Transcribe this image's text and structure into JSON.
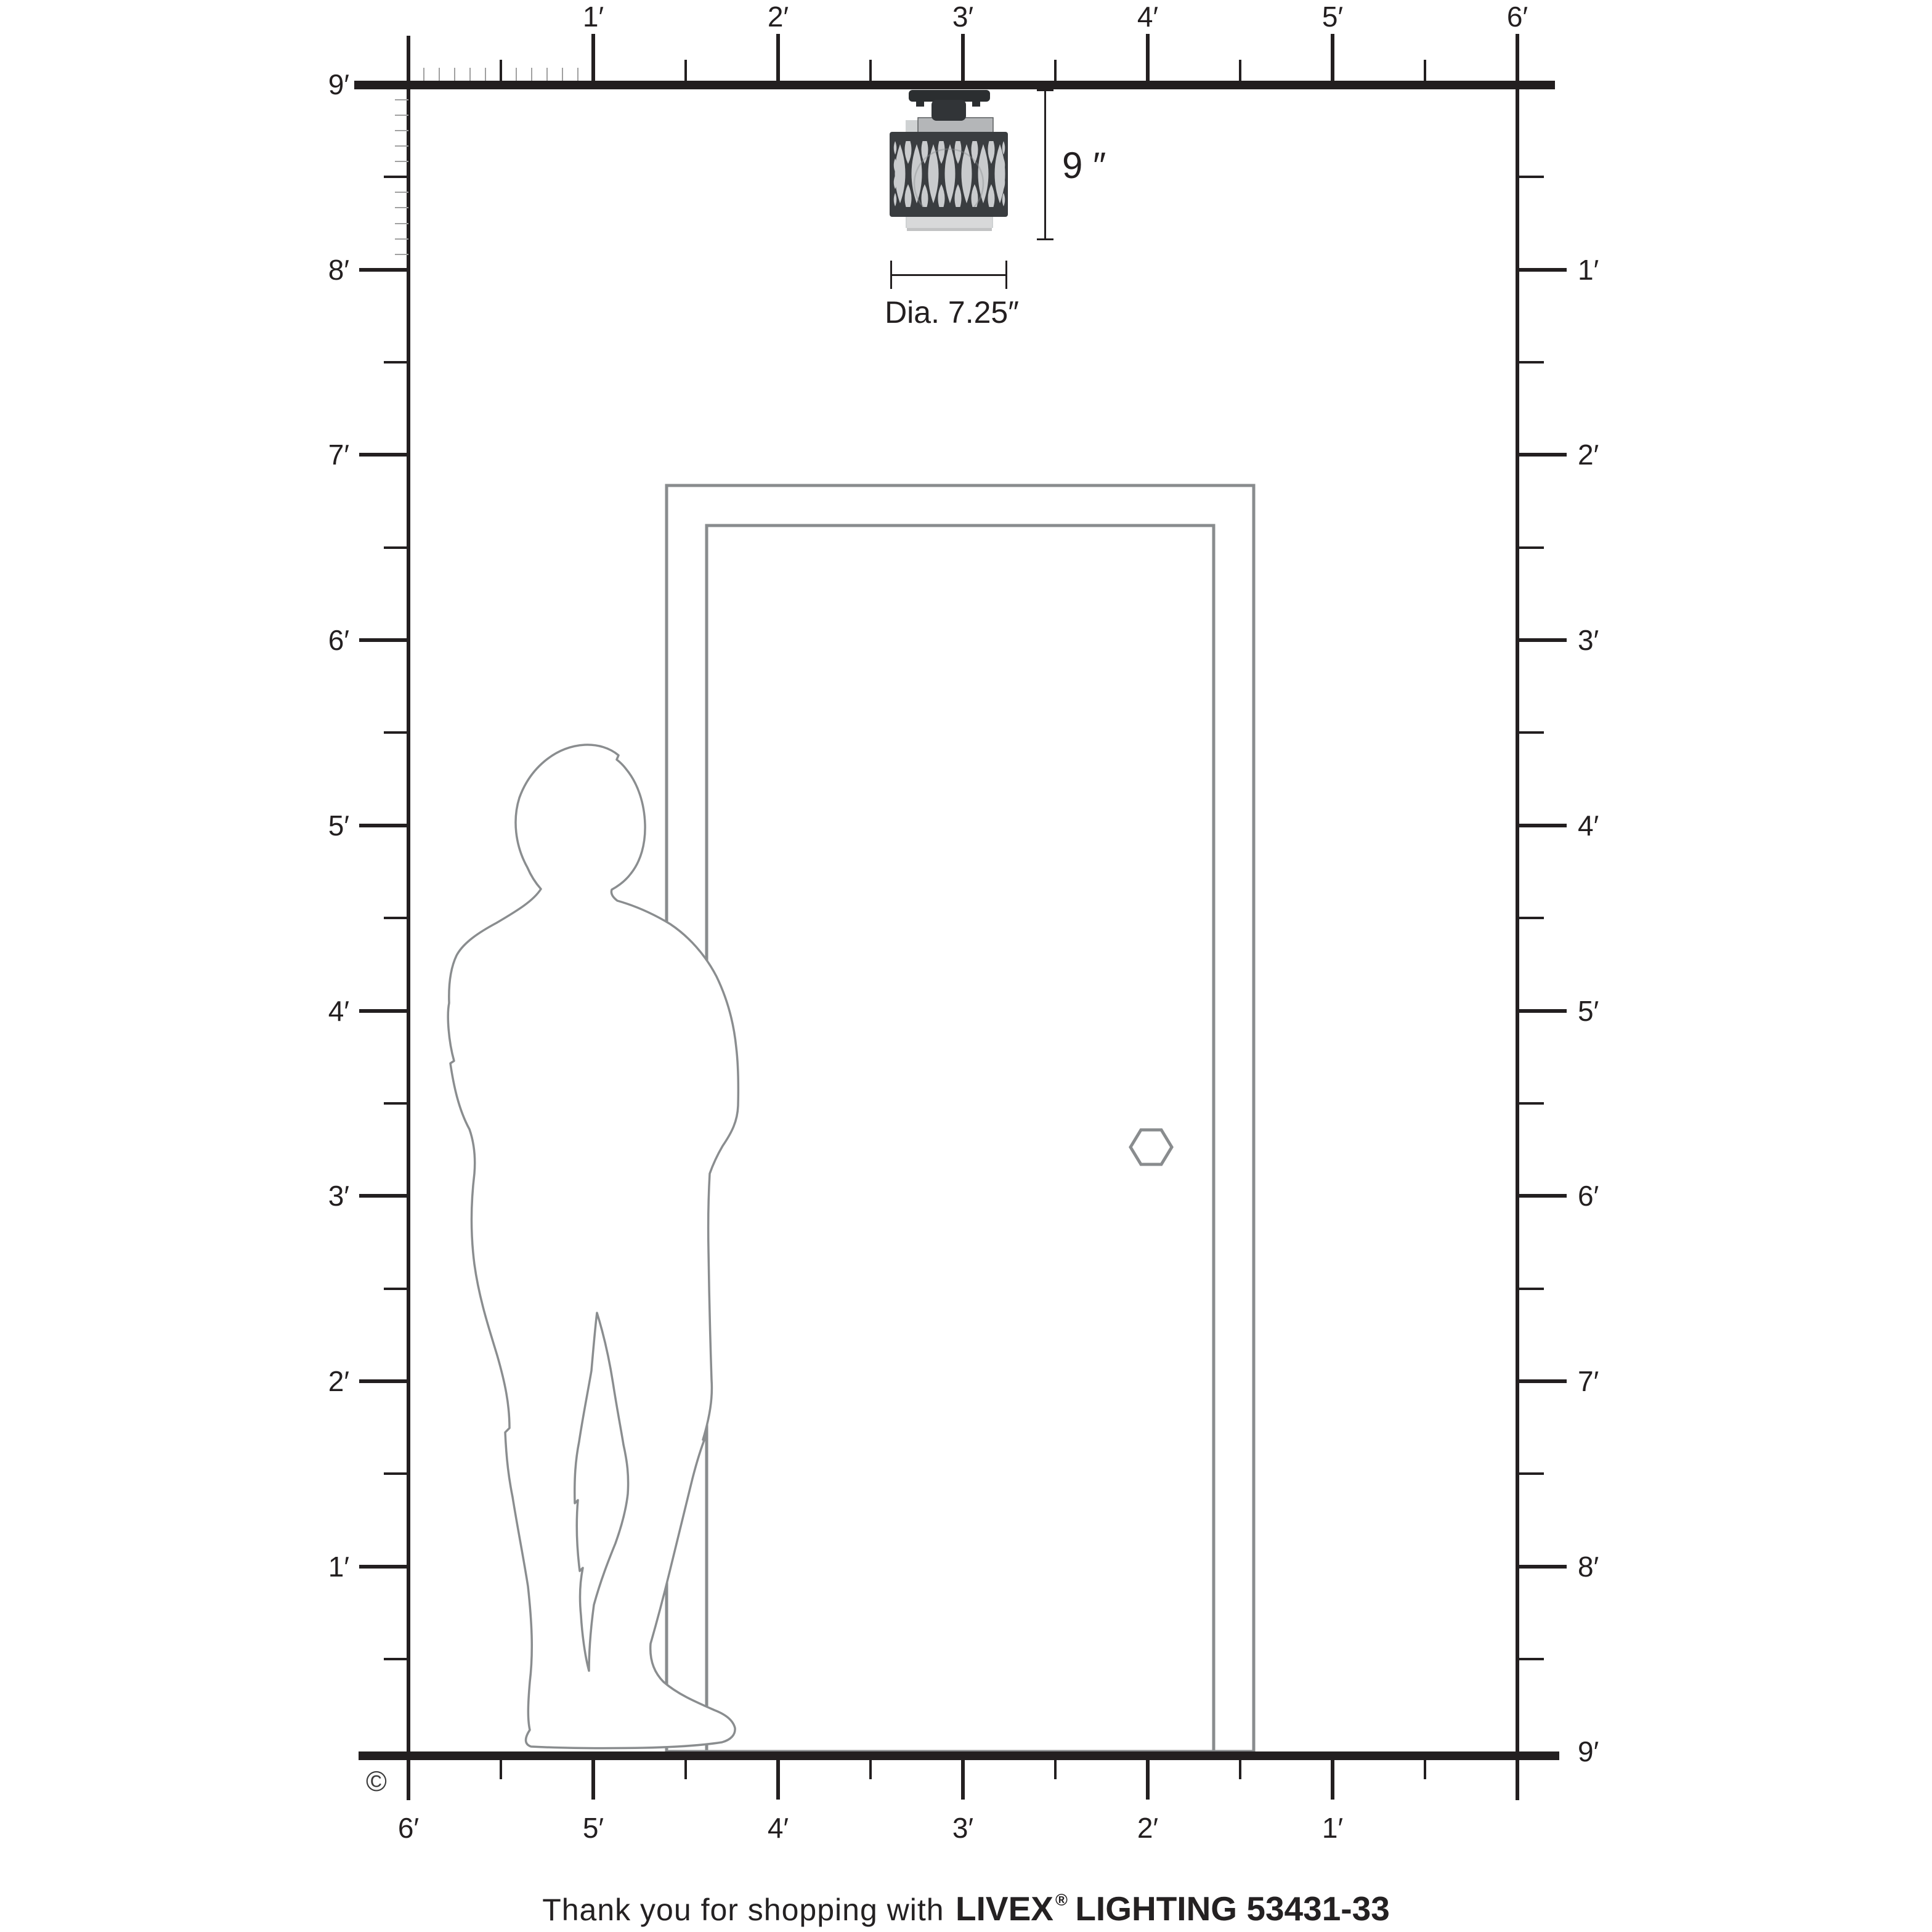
{
  "diagram": {
    "kind": "product-size-diagram",
    "copyright_symbol": "©"
  },
  "rulers": {
    "top": {
      "unit": "feet",
      "labels": [
        "1′",
        "2′",
        "3′",
        "4′",
        "5′",
        "6′"
      ]
    },
    "left": {
      "unit": "feet",
      "labels": [
        "9′",
        "8′",
        "7′",
        "6′",
        "5′",
        "4′",
        "3′",
        "2′",
        "1′"
      ]
    },
    "right": {
      "unit": "feet",
      "labels": [
        "1′",
        "2′",
        "3′",
        "4′",
        "5′",
        "6′",
        "7′",
        "8′",
        "9′"
      ]
    },
    "bottom": {
      "unit": "feet",
      "labels": [
        "6′",
        "5′",
        "4′",
        "3′",
        "2′",
        "1′"
      ]
    }
  },
  "fixture": {
    "height_label": "9 ″",
    "diameter_label": "Dia. 7.25″"
  },
  "footer": {
    "prefix": "Thank you for shopping with",
    "brand": "LIVEX",
    "registered_mark": "®",
    "suffix": "LIGHTING 53431-33"
  },
  "colors": {
    "ink": "#231f20",
    "outline": "#8a8d8f",
    "fixture_dark": "#3a3d40",
    "fixture_darker": "#2b2e30",
    "glass": "#c9cbcd",
    "glass_light": "#d8d9da",
    "minor_tick": "#a0a0a0"
  }
}
